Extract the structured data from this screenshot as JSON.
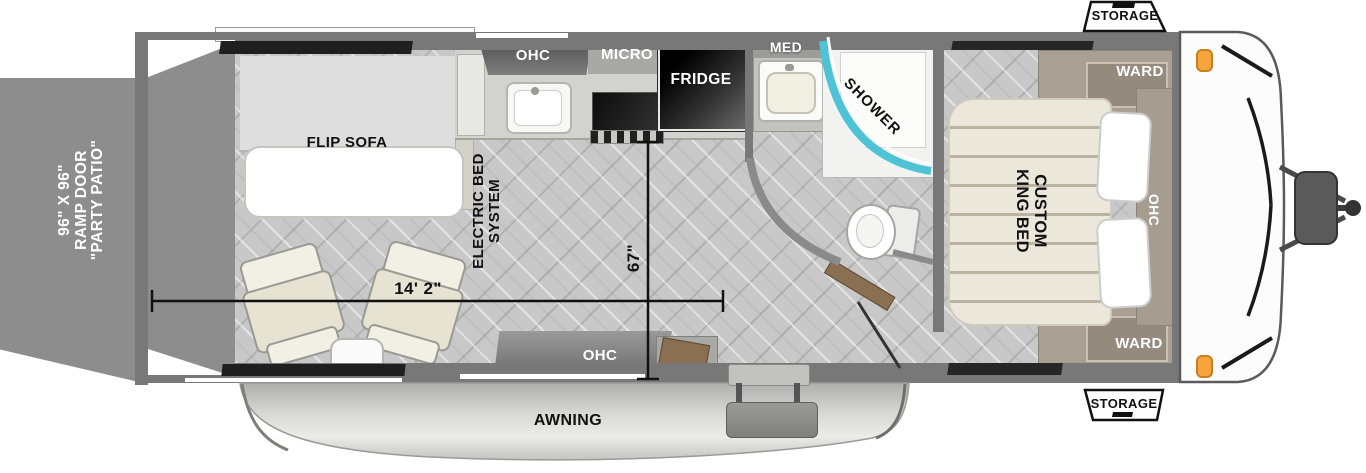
{
  "title": "Toy hauler travel trailer floor plan",
  "ramp_door": {
    "label": "96\" X 96\"\nRAMP DOOR\n\"PARTY PATIO\""
  },
  "living_area": {
    "flip_sofa": "FLIP SOFA",
    "electric_bed_system": "ELECTRIC BED\nSYSTEM"
  },
  "kitchen": {
    "overhead_cabinet": "OHC",
    "microwave": "MICRO",
    "fridge": "FRIDGE",
    "overhead_cabinet_bottom": "OHC"
  },
  "bathroom": {
    "medicine_cabinet": "MED",
    "shower": "SHOWER"
  },
  "bedroom": {
    "bed": "CUSTOM\nKING BED",
    "overhead_cabinet": "OHC",
    "wardrobe_top": "WARD",
    "wardrobe_bottom": "WARD"
  },
  "exterior": {
    "storage_top": "STORAGE",
    "storage_bottom": "STORAGE",
    "awning": "AWNING"
  },
  "dimensions": {
    "interior_length": "14' 2\"",
    "slide_width": "67\""
  },
  "colors": {
    "wall": "#787878",
    "ramp_door": "#8d8d8d",
    "floor": "#c8c8c8",
    "shower_glass": "#4fc3d6",
    "cabinet_taupe": "#a99f93",
    "mattress": "#ebe7db",
    "fridge": "#0d0d0d",
    "marker_light": "#f5a53c",
    "window": "#1f1f1f"
  }
}
